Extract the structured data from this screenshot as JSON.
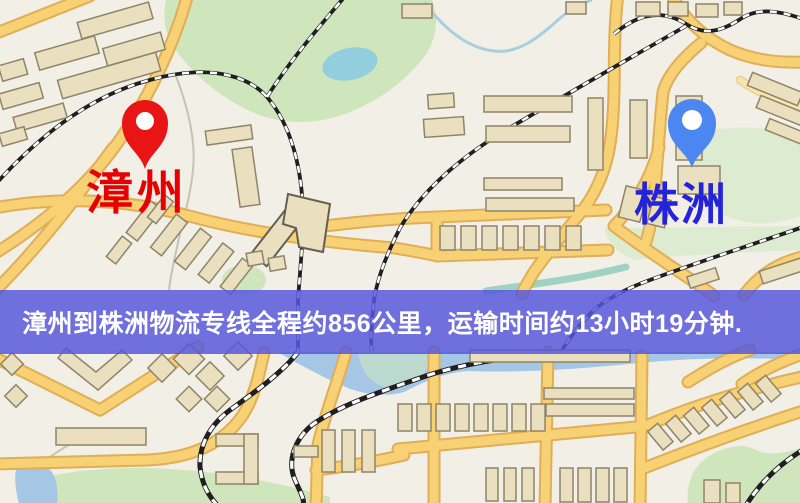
{
  "map": {
    "origin": {
      "name": "漳州"
    },
    "destination": {
      "name": "株洲"
    },
    "banner": {
      "text": "漳州到株洲物流专线全程约856公里，运输时间约13小时19分钟."
    },
    "route": {
      "distance_km": 856,
      "duration_hours": 13,
      "duration_minutes": 19
    }
  },
  "colors": {
    "map-bg": "#f2efe7",
    "road-fill": "#f8d175",
    "road-border": "#dfae56",
    "road-minor": "#f6e5ad",
    "building-fill": "#eae0c0",
    "building-stroke": "#8f8468",
    "green-area": "#cfe5bb",
    "green-area-light": "#ddebd0",
    "water": "#a6c6e6",
    "water-lake": "#93cede",
    "rail-dark": "#1f1f1f",
    "banner-bg": "rgba(86,86,219,0.84)",
    "banner-text": "#ffffff",
    "origin-pin": "#e91414",
    "origin-label": "#e60000",
    "dest-pin": "#4c86f0",
    "dest-label": "#2323d9",
    "pin-hole": "#ffffff"
  }
}
